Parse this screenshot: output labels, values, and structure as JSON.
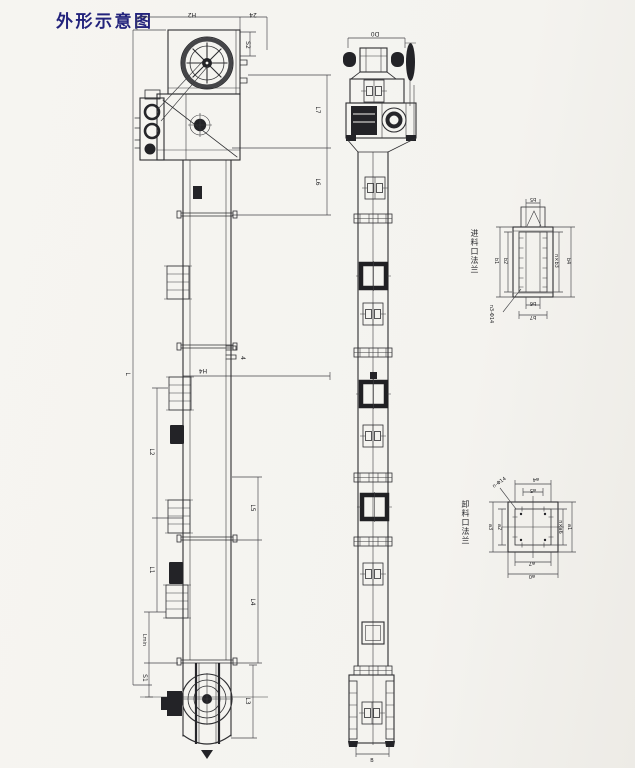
{
  "page": {
    "title": "外形示意图"
  },
  "side_view": {
    "dims": {
      "H2": "H2",
      "d24": "24",
      "S2": "S2",
      "L7": "L7",
      "L6": "L6",
      "H4": "H4",
      "n4": "4",
      "L": "L",
      "L2": "L2",
      "L1": "L1",
      "Lmin": "Lmin",
      "S1": "S1",
      "L5": "L5",
      "L4": "L4",
      "L3": "L3"
    }
  },
  "front_view": {
    "dims": {
      "D0": "D0",
      "B": "B"
    }
  },
  "inlet_flange": {
    "title": "进料口法兰",
    "dims": {
      "b1": "b1",
      "b2": "b2",
      "b3": "n×b3",
      "b4": "b4",
      "b5": "b5",
      "b6": "b6",
      "b7": "b7",
      "holes": "n3-Φ14"
    }
  },
  "outlet_flange": {
    "title": "卸料口法兰",
    "dims": {
      "a0": "a0",
      "a1": "a1",
      "a2": "a2",
      "a3": "a3",
      "a4": "a4",
      "a5": "a5",
      "a6": "n×a6",
      "a7": "a7",
      "holes": "n-Φ14"
    }
  }
}
